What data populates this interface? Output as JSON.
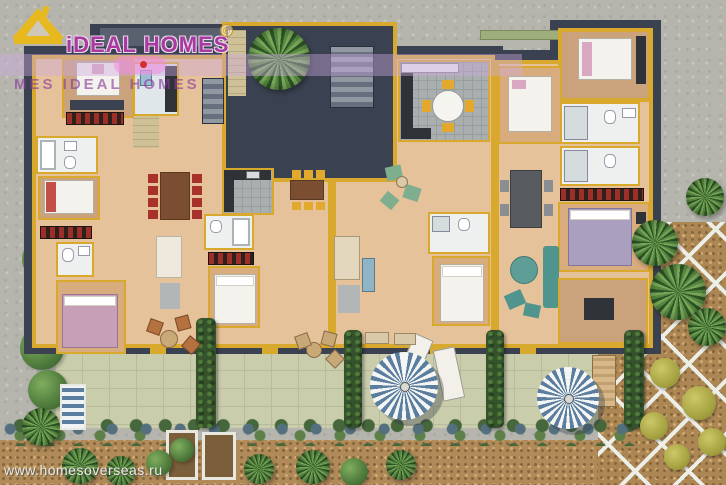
{
  "watermarks": {
    "logo_text": "iDEAL HOMES",
    "logo_registered": "®",
    "band_text": "MES IDEAL HOMES",
    "website": "www.homesoverseas.ru"
  },
  "palette": {
    "wall_yellow": "#d8a92c",
    "roof_charcoal": "#3a4150",
    "wood_floor": "#e6c29a",
    "patio_paver": "#c9cdab",
    "hedge_green": "#35522c",
    "gravel_brown": "#b08a58",
    "umbrella_blue": "#5b7da0",
    "logo_magenta": "#a93a9f",
    "bed_pink": "#c79fb7",
    "bed_purple": "#ab9fc0",
    "chair_red": "#a8322b",
    "chair_yellow": "#e3a92c",
    "sofa_teal": "#4f958d"
  }
}
